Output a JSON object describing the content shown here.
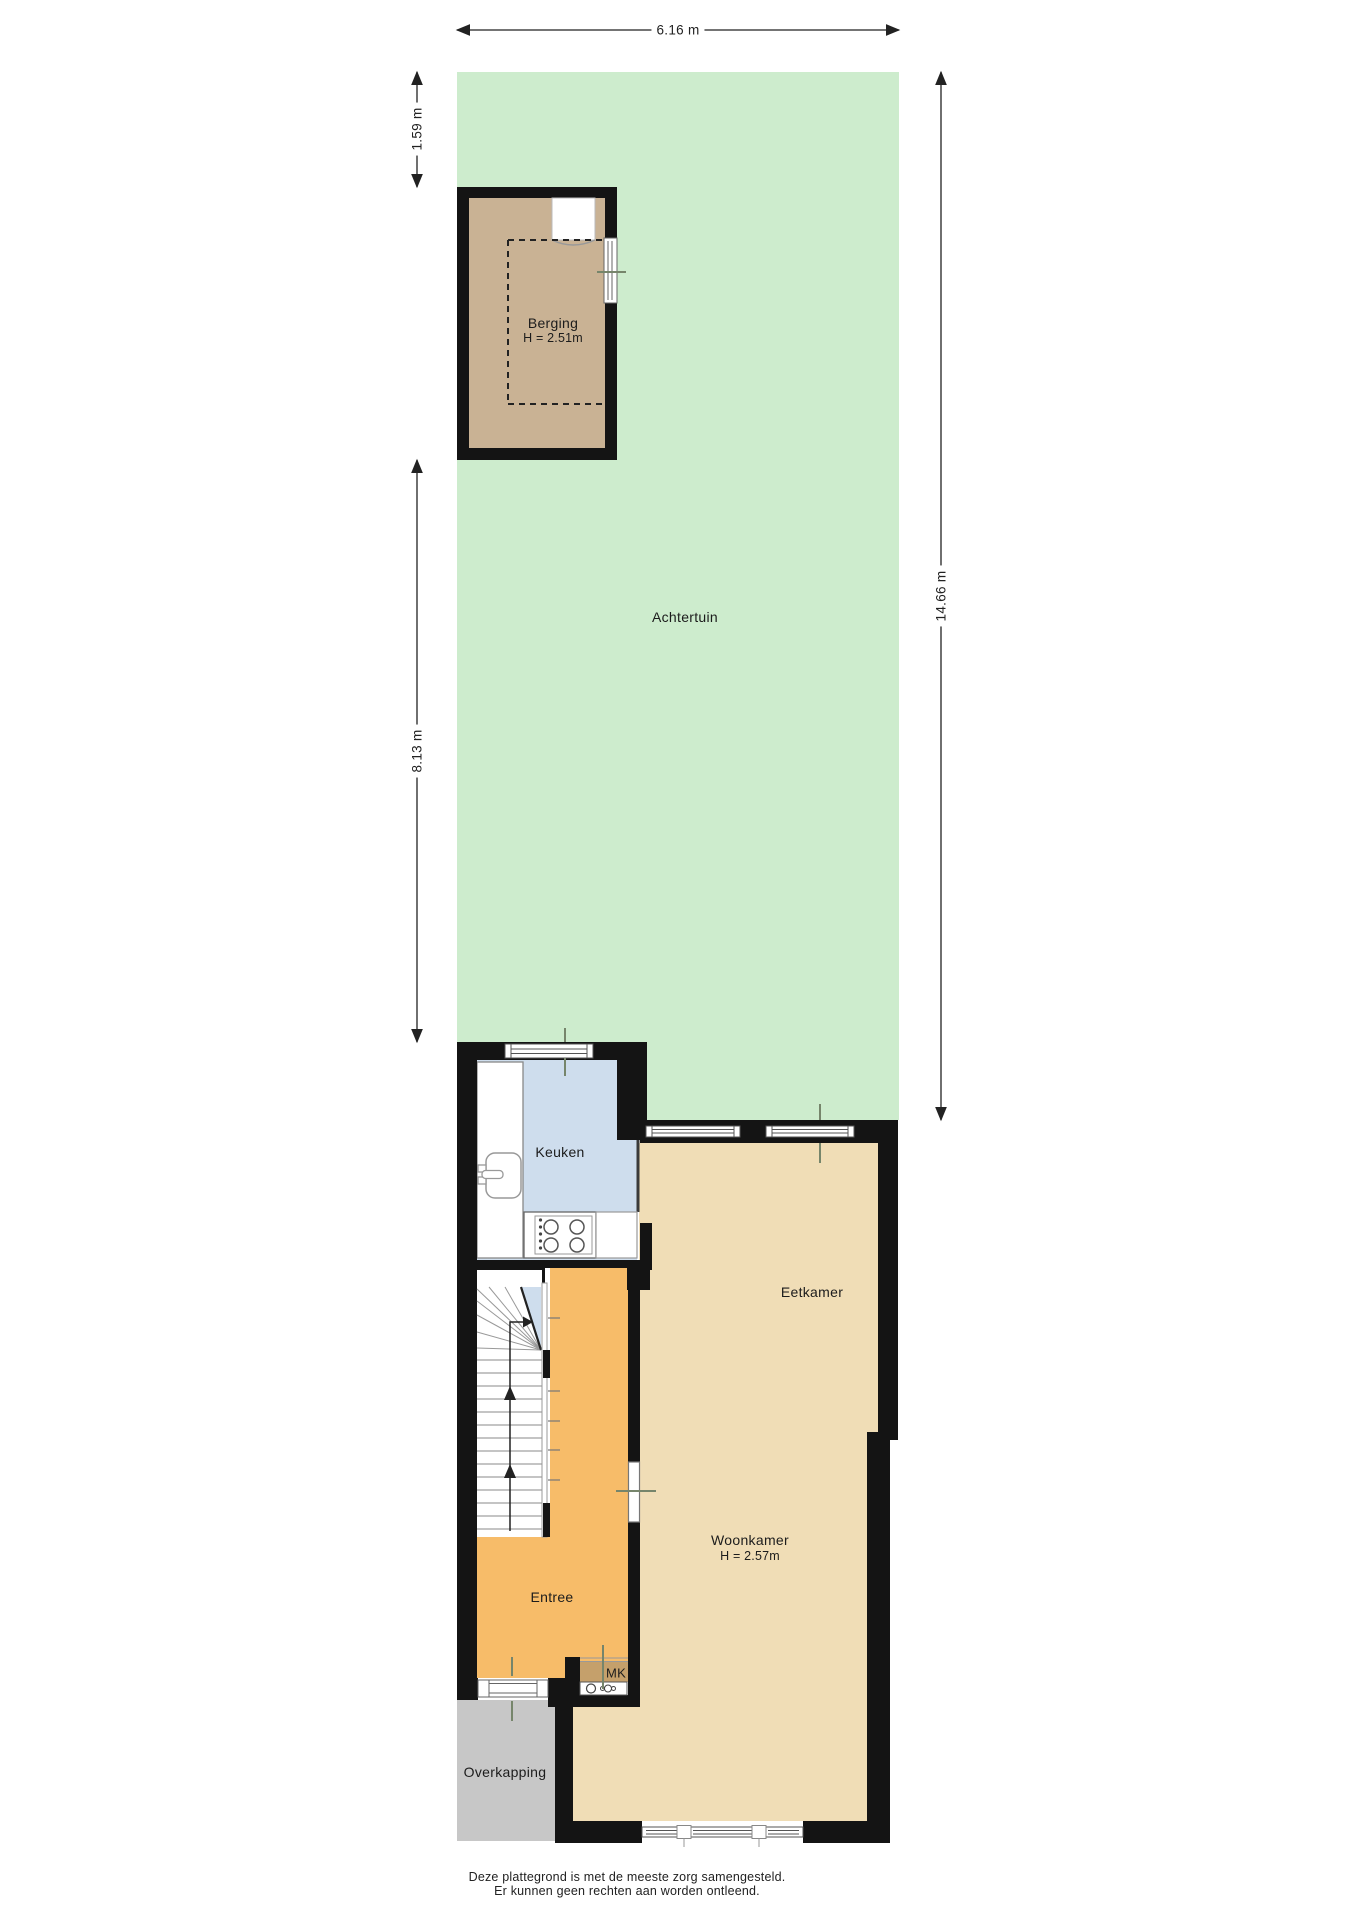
{
  "title": "Plattegrond begane grond met tuin",
  "dimensions": {
    "top_width": "6.16 m",
    "left_upper": "1.59 m",
    "left_lower": "8.13 m",
    "right_height": "14.66 m"
  },
  "rooms": {
    "achtertuin": {
      "label": "Achtertuin"
    },
    "berging": {
      "label": "Berging",
      "height": "H = 2.51m"
    },
    "keuken": {
      "label": "Keuken"
    },
    "eetkamer": {
      "label": "Eetkamer"
    },
    "woonkamer": {
      "label": "Woonkamer",
      "height": "H = 2.57m"
    },
    "entree": {
      "label": "Entree"
    },
    "mk": {
      "label": "MK"
    },
    "overkapping": {
      "label": "Overkapping"
    }
  },
  "footer": {
    "line1": "Deze plattegrond is met de meeste zorg samengesteld.",
    "line2": "Er kunnen geen rechten aan worden ontleend."
  },
  "colors": {
    "garden_green": "#cdeccd",
    "berging_floor": "#c9b294",
    "kitchen_blue": "#cedded",
    "living_tan": "#f0ddb6",
    "entree_orange": "#f7bc69",
    "overkapping_gray": "#c7c7c7",
    "mk_floor": "#c5a06b",
    "wall_black": "#141414",
    "tick_olive": "#76856b"
  }
}
